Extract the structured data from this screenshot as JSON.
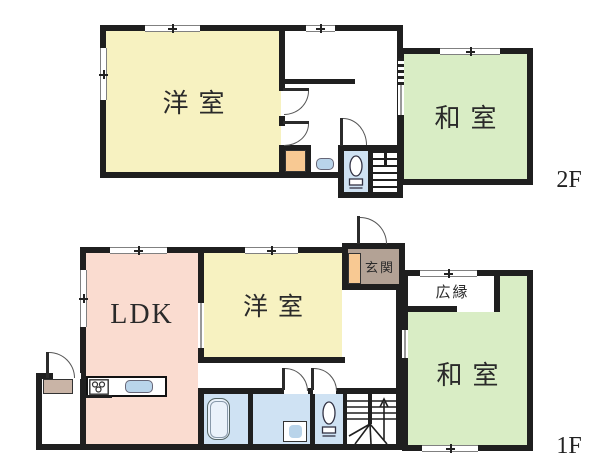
{
  "colors": {
    "wall": "#1f1f1f",
    "western_room": "#f7f2c1",
    "japanese_room": "#d9edc5",
    "ldk": "#fadcd0",
    "entrance": "#b3a295",
    "closet": "#f8c993",
    "water": "#cfe2f3",
    "fixture": "#b9d4ea"
  },
  "floor2": {
    "label": "2F",
    "rooms": {
      "western": {
        "label": "洋室"
      },
      "japanese": {
        "label": "和室"
      }
    }
  },
  "floor1": {
    "label": "1F",
    "rooms": {
      "ldk": {
        "label": "LDK"
      },
      "western": {
        "label": "洋室"
      },
      "entrance": {
        "label": "玄関"
      },
      "veranda": {
        "label": "広縁"
      },
      "japanese": {
        "label": "和室"
      }
    }
  }
}
